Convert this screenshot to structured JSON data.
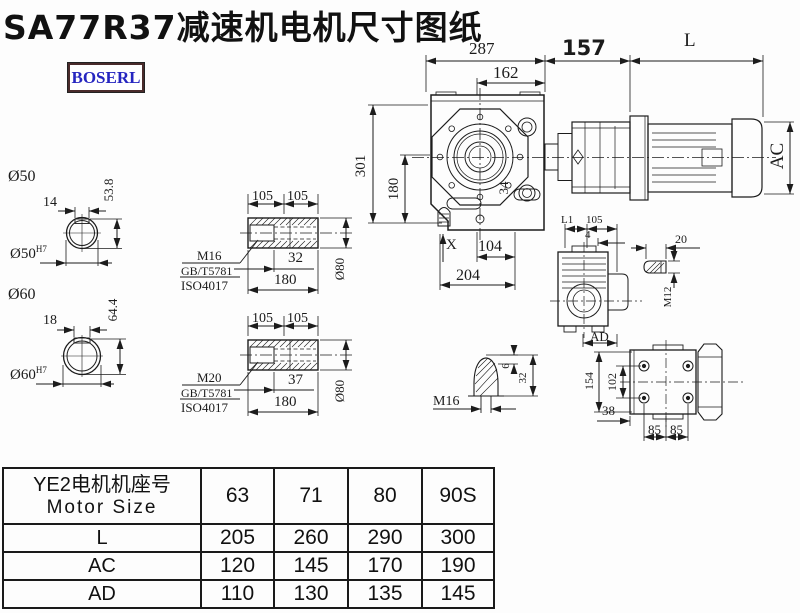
{
  "title": "SA77R37减速机电机尺寸图纸",
  "logo": {
    "text": "BOSERL"
  },
  "colors": {
    "line": "#1c1c1c",
    "logo_text": "#2626c0",
    "logo_border": "#4a2b2b",
    "paper": "#fdfdfd"
  },
  "main_view": {
    "d287": "287",
    "d162": "162",
    "d157": "157",
    "dL": "L",
    "d301": "301",
    "d180": "180",
    "d34": "34",
    "dX": "X",
    "d104": "104",
    "d204": "204",
    "dAC": "AC"
  },
  "bore50": {
    "label": "Ø50",
    "key_w": "14",
    "key_h": "53.8",
    "fit": "Ø50",
    "fit_sup": "H7"
  },
  "bore60": {
    "label": "Ø60",
    "key_w": "18",
    "key_h": "64.4",
    "fit": "Ø60",
    "fit_sup": "H7"
  },
  "shaft_input_view": {
    "d105a": "105",
    "d105b": "105",
    "m": "M16",
    "std1": "GB/T5781",
    "std2": "ISO4017",
    "d32": "32",
    "d180": "180",
    "o80": "Ø80"
  },
  "shaft_output_view": {
    "d105a": "105",
    "d105b": "105",
    "m": "M20",
    "std1": "GB/T5781",
    "std2": "ISO4017",
    "d37": "37",
    "d180": "180",
    "o80": "Ø80"
  },
  "side_view": {
    "l1": "L1",
    "d105": "105",
    "d4": "4",
    "ad": "AD"
  },
  "key_view": {
    "d20": "20",
    "m12": "M12"
  },
  "plug_view": {
    "d6": "6",
    "d32": "32",
    "m16": "M16"
  },
  "flange_view": {
    "d154": "154",
    "d102": "102",
    "d38": "38",
    "d85a": "85",
    "d85b": "85"
  },
  "table": {
    "header_cn": "YE2电机机座号",
    "header_en": "Motor Size",
    "columns": [
      "63",
      "71",
      "80",
      "90S"
    ],
    "rows": [
      {
        "label": "L",
        "values": [
          "205",
          "260",
          "290",
          "300"
        ]
      },
      {
        "label": "AC",
        "values": [
          "120",
          "145",
          "170",
          "190"
        ]
      },
      {
        "label": "AD",
        "values": [
          "110",
          "130",
          "135",
          "145"
        ]
      }
    ]
  }
}
